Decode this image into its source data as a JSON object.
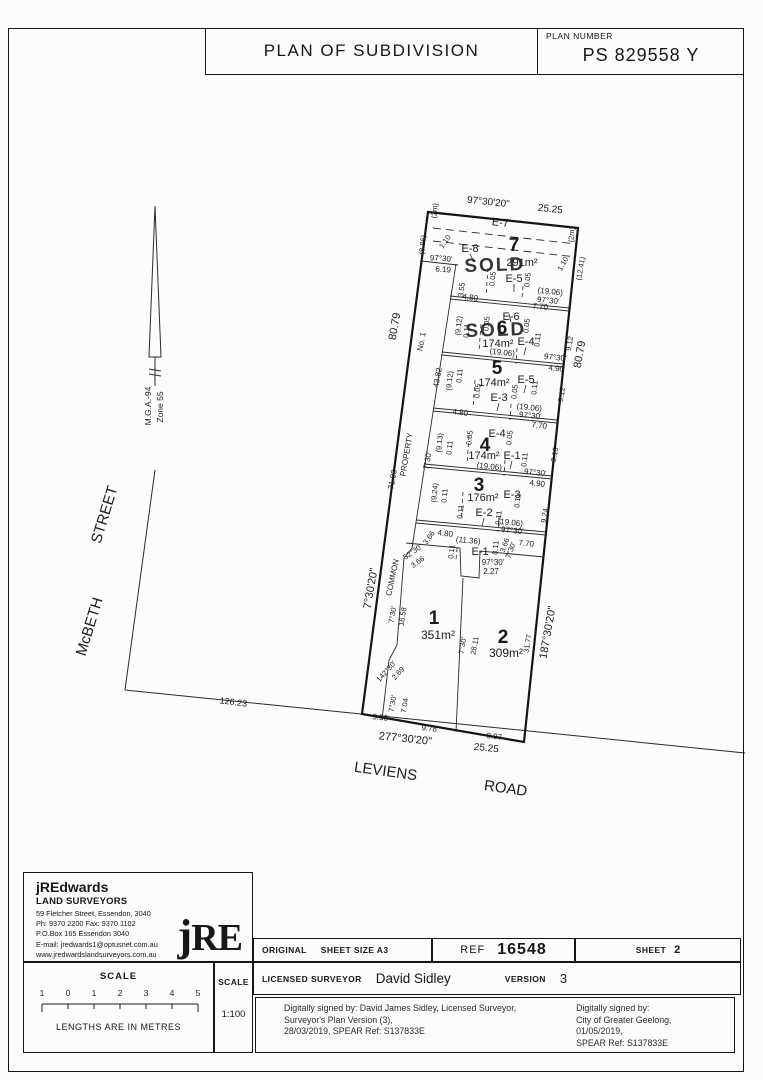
{
  "title_block": {
    "title": "PLAN OF SUBDIVISION",
    "plan_number_label": "PLAN NUMBER",
    "plan_number": "PS 829558 Y"
  },
  "surveyor_box": {
    "name": "jREdwards",
    "subtitle": "LAND SURVEYORS",
    "address1": "59 Fletcher Street, Essendon, 3040",
    "phone": "Ph: 9370 2200      Fax: 9370 1102",
    "address2": "P.O.Box 165 Essendon 3040",
    "email": "E-mail: jredwards1@optusnet.com.au",
    "website": "www.jredwardslandsurveyors.com.au",
    "logo": "RE",
    "logo_j": "j"
  },
  "scale_box": {
    "label": "SCALE",
    "ticks": [
      "1",
      "0",
      "1",
      "2",
      "3",
      "4",
      "5"
    ],
    "caption": "LENGTHS ARE IN METRES",
    "ratio_label": "SCALE",
    "ratio": "1:100"
  },
  "info_row": {
    "original_label": "ORIGINAL",
    "sheet_size": "SHEET SIZE A3",
    "ref_label": "REF",
    "ref_value": "16548",
    "sheet_label": "SHEET",
    "sheet_value": "2"
  },
  "surveyor_row": {
    "licensed_label": "LICENSED SURVEYOR",
    "surveyor_name": "David Sidley",
    "version_label": "VERSION",
    "version_value": "3"
  },
  "signatures": {
    "left": [
      "Digitally signed by: David James Sidley, Licensed Surveyor,",
      "Surveyor's Plan Version (3),",
      "28/03/2019, SPEAR Ref: S137833E"
    ],
    "right": [
      "Digitally signed by:",
      "City of Greater Geelong,",
      "01/05/2019,",
      "SPEAR Ref: S137833E"
    ]
  },
  "plan": {
    "sold_color": "#b63a2e",
    "labels": [
      {
        "t": "97°30'20\"",
        "x": 488,
        "y": 205,
        "r": 6,
        "s": 10
      },
      {
        "t": "25.25",
        "x": 550,
        "y": 212,
        "r": 6,
        "s": 10
      },
      {
        "t": "E-7",
        "x": 500,
        "y": 226,
        "r": 6,
        "s": 11,
        "n": "easement-e7-label"
      },
      {
        "t": "(2m)",
        "x": 437,
        "y": 211,
        "r": -84,
        "s": 7.5
      },
      {
        "t": "(8.86)",
        "x": 425,
        "y": 245,
        "r": -84,
        "s": 7.5
      },
      {
        "t": "1.10",
        "x": 447,
        "y": 243,
        "r": -55,
        "s": 7.5
      },
      {
        "t": "E-8",
        "x": 470,
        "y": 252,
        "s": 11,
        "n": "easement-e8-label"
      },
      {
        "t": "7",
        "x": 514,
        "y": 251,
        "s": 19,
        "w": "b",
        "n": "lot-7-number"
      },
      {
        "t": "291m²",
        "x": 522,
        "y": 266,
        "s": 11,
        "n": "lot-7-area"
      },
      {
        "t": "SOLD",
        "x": 495,
        "y": 271,
        "r": -2,
        "s": 19,
        "w": "b",
        "c": "sold",
        "n": "sold-stamp-lot-7"
      },
      {
        "t": "97°30'",
        "x": 441,
        "y": 261,
        "r": 4,
        "s": 8
      },
      {
        "t": "6.19",
        "x": 443,
        "y": 272,
        "r": 4,
        "s": 8
      },
      {
        "t": "E-5",
        "x": 514,
        "y": 282,
        "s": 11,
        "n": "easement-e5-label"
      },
      {
        "t": "0.05",
        "x": 495,
        "y": 279,
        "r": -84,
        "s": 7.5
      },
      {
        "t": "0.05",
        "x": 530,
        "y": 280,
        "r": -84,
        "s": 7.5
      },
      {
        "t": "3.55",
        "x": 464,
        "y": 290,
        "r": -84,
        "s": 7.5
      },
      {
        "t": "(19.06)",
        "x": 550,
        "y": 294,
        "r": 6,
        "s": 8
      },
      {
        "t": "97°30'",
        "x": 548,
        "y": 303,
        "r": 6,
        "s": 8
      },
      {
        "t": "4.80",
        "x": 470,
        "y": 300,
        "r": 6,
        "s": 8
      },
      {
        "t": "7.70",
        "x": 540,
        "y": 309,
        "r": 6,
        "s": 8
      },
      {
        "t": "(2m)",
        "x": 574,
        "y": 235,
        "r": -84,
        "s": 7.5
      },
      {
        "t": "1.10",
        "x": 565,
        "y": 265,
        "r": -60,
        "s": 7.5
      },
      {
        "t": "(12.41)",
        "x": 583,
        "y": 269,
        "r": -80,
        "s": 7.5
      },
      {
        "t": "(9.12)",
        "x": 461,
        "y": 326,
        "r": -84,
        "s": 7.5
      },
      {
        "t": "0.11",
        "x": 469,
        "y": 331,
        "r": -84,
        "s": 7.5
      },
      {
        "t": "0.05",
        "x": 489,
        "y": 324,
        "r": -84,
        "s": 7.5
      },
      {
        "t": "E-6",
        "x": 511,
        "y": 320,
        "s": 11,
        "n": "easement-e6-label"
      },
      {
        "t": "0.05",
        "x": 529,
        "y": 326,
        "r": -84,
        "s": 7.5
      },
      {
        "t": "6",
        "x": 502,
        "y": 334,
        "s": 19,
        "w": "b",
        "n": "lot-6-number"
      },
      {
        "t": "SOLD",
        "x": 496,
        "y": 336,
        "r": -2,
        "s": 19,
        "w": "b",
        "c": "sold",
        "n": "sold-stamp-lot-6"
      },
      {
        "t": "174m²",
        "x": 498,
        "y": 347,
        "s": 11,
        "n": "lot-6-area"
      },
      {
        "t": "E-4",
        "x": 526,
        "y": 345,
        "s": 11,
        "n": "easement-e4-label"
      },
      {
        "t": "0.11",
        "x": 540,
        "y": 340,
        "r": -84,
        "s": 7.5
      },
      {
        "t": "(19.06)",
        "x": 502,
        "y": 355,
        "r": 6,
        "s": 8
      },
      {
        "t": "9.12",
        "x": 572,
        "y": 344,
        "r": -80,
        "s": 7.5
      },
      {
        "t": "80.79",
        "x": 583,
        "y": 355,
        "r": -80,
        "s": 11
      },
      {
        "t": "97°30'",
        "x": 555,
        "y": 360,
        "r": 6,
        "s": 8
      },
      {
        "t": "4.90",
        "x": 556,
        "y": 371,
        "r": 6,
        "s": 8
      },
      {
        "t": "No. 1",
        "x": 424,
        "y": 342,
        "r": -80,
        "s": 8
      },
      {
        "t": "80.79",
        "x": 398,
        "y": 327,
        "r": -80,
        "s": 11
      },
      {
        "t": "43.82",
        "x": 440,
        "y": 378,
        "r": -80,
        "s": 8
      },
      {
        "t": "(9.12)",
        "x": 452,
        "y": 381,
        "r": -84,
        "s": 7.5
      },
      {
        "t": "0.11",
        "x": 462,
        "y": 376,
        "r": -84,
        "s": 7.5
      },
      {
        "t": "5",
        "x": 497,
        "y": 374,
        "s": 19,
        "w": "b",
        "n": "lot-5-number"
      },
      {
        "t": "174m²",
        "x": 494,
        "y": 386,
        "s": 11,
        "n": "lot-5-area"
      },
      {
        "t": "E-5",
        "x": 526,
        "y": 383,
        "s": 11
      },
      {
        "t": "0.05",
        "x": 480,
        "y": 391,
        "r": -84,
        "s": 7.5
      },
      {
        "t": "0.05",
        "x": 517,
        "y": 392,
        "r": -84,
        "s": 7.5
      },
      {
        "t": "0.11",
        "x": 537,
        "y": 388,
        "r": -84,
        "s": 7.5
      },
      {
        "t": "E-3",
        "x": 499,
        "y": 401,
        "s": 11,
        "n": "easement-e3-label"
      },
      {
        "t": "9.12",
        "x": 564,
        "y": 395,
        "r": -80,
        "s": 7.5
      },
      {
        "t": "(19.06)",
        "x": 529,
        "y": 410,
        "r": 6,
        "s": 8
      },
      {
        "t": "97°30'",
        "x": 530,
        "y": 418,
        "r": 6,
        "s": 8
      },
      {
        "t": "4.80",
        "x": 460,
        "y": 415,
        "r": 6,
        "s": 8
      },
      {
        "t": "7.70",
        "x": 539,
        "y": 428,
        "r": 6,
        "s": 8
      },
      {
        "t": "E-4",
        "x": 497,
        "y": 437,
        "s": 11
      },
      {
        "t": "0.05",
        "x": 472,
        "y": 438,
        "r": -84,
        "s": 7.5
      },
      {
        "t": "0.05",
        "x": 512,
        "y": 438,
        "r": -84,
        "s": 7.5
      },
      {
        "t": "(9.13)",
        "x": 442,
        "y": 443,
        "r": -84,
        "s": 7.5
      },
      {
        "t": "0.11",
        "x": 452,
        "y": 448,
        "r": -84,
        "s": 7.5
      },
      {
        "t": "4",
        "x": 485,
        "y": 451,
        "s": 19,
        "w": "b",
        "n": "lot-4-number"
      },
      {
        "t": "174m²",
        "x": 484,
        "y": 459,
        "s": 11,
        "n": "lot-4-area"
      },
      {
        "t": "E-1",
        "x": 512,
        "y": 459,
        "s": 11,
        "n": "easement-e1-label"
      },
      {
        "t": "0.11",
        "x": 527,
        "y": 460,
        "r": -84,
        "s": 7.5
      },
      {
        "t": "(19.06)",
        "x": 489,
        "y": 469,
        "r": 6,
        "s": 8
      },
      {
        "t": "9.13",
        "x": 557,
        "y": 455,
        "r": -80,
        "s": 7.5
      },
      {
        "t": "97°30'",
        "x": 535,
        "y": 475,
        "r": 6,
        "s": 8
      },
      {
        "t": "4.90",
        "x": 537,
        "y": 486,
        "r": 6,
        "s": 8
      },
      {
        "t": "7°30'",
        "x": 430,
        "y": 461,
        "r": -80,
        "s": 8
      },
      {
        "t": "PROPERTY",
        "x": 409,
        "y": 455,
        "r": -80,
        "s": 8,
        "n": "common-property-label"
      },
      {
        "t": "71.93",
        "x": 395,
        "y": 480,
        "r": -80,
        "s": 8
      },
      {
        "t": "3",
        "x": 479,
        "y": 491,
        "s": 19,
        "w": "b",
        "n": "lot-3-number"
      },
      {
        "t": "(9.24)",
        "x": 437,
        "y": 493,
        "r": -84,
        "s": 7.5
      },
      {
        "t": "0.11",
        "x": 447,
        "y": 496,
        "r": -84,
        "s": 7.5
      },
      {
        "t": "176m²",
        "x": 483,
        "y": 501,
        "s": 11,
        "n": "lot-3-area"
      },
      {
        "t": "E-3",
        "x": 512,
        "y": 498,
        "s": 11
      },
      {
        "t": "0.11",
        "x": 520,
        "y": 501,
        "r": -84,
        "s": 7.5
      },
      {
        "t": "E-2",
        "x": 484,
        "y": 516,
        "s": 11,
        "n": "easement-e2-label"
      },
      {
        "t": "0.11",
        "x": 463,
        "y": 512,
        "r": -84,
        "s": 7.5
      },
      {
        "t": "0.11",
        "x": 501,
        "y": 518,
        "r": -84,
        "s": 7.5
      },
      {
        "t": "9.24",
        "x": 547,
        "y": 516,
        "r": -80,
        "s": 7.5
      },
      {
        "t": "(19.06)",
        "x": 510,
        "y": 525,
        "r": 6,
        "s": 8
      },
      {
        "t": "97°30'",
        "x": 512,
        "y": 533,
        "r": 6,
        "s": 8
      },
      {
        "t": "3.66",
        "x": 431,
        "y": 539,
        "r": -55,
        "s": 7.5
      },
      {
        "t": "4.80",
        "x": 445,
        "y": 536,
        "r": 6,
        "s": 8
      },
      {
        "t": "(11.36)",
        "x": 468,
        "y": 543,
        "r": 6,
        "s": 8
      },
      {
        "t": "0.11",
        "x": 454,
        "y": 552,
        "r": -84,
        "s": 7.5
      },
      {
        "t": "E-1",
        "x": 480,
        "y": 555,
        "s": 11
      },
      {
        "t": "0.11",
        "x": 498,
        "y": 548,
        "r": -84,
        "s": 7.5
      },
      {
        "t": "3.66",
        "x": 507,
        "y": 546,
        "r": -70,
        "s": 7.5
      },
      {
        "t": "7°30'",
        "x": 513,
        "y": 551,
        "r": -70,
        "s": 7.5
      },
      {
        "t": "7.70",
        "x": 526,
        "y": 546,
        "r": 6,
        "s": 8
      },
      {
        "t": "97°30'",
        "x": 493,
        "y": 565,
        "s": 8
      },
      {
        "t": "2.27",
        "x": 491,
        "y": 574,
        "s": 8
      },
      {
        "t": "52°30'",
        "x": 414,
        "y": 554,
        "r": -35,
        "s": 7.5
      },
      {
        "t": "3.66",
        "x": 419,
        "y": 564,
        "r": -35,
        "s": 7.5
      },
      {
        "t": "COMMON",
        "x": 395,
        "y": 578,
        "r": -78,
        "s": 8,
        "n": "common-property-label"
      },
      {
        "t": "7°30'20\"",
        "x": 374,
        "y": 589,
        "r": -80,
        "s": 11
      },
      {
        "t": "7°30'",
        "x": 395,
        "y": 615,
        "r": -80,
        "s": 7.5
      },
      {
        "t": "16.58",
        "x": 405,
        "y": 617,
        "r": -80,
        "s": 7.5
      },
      {
        "t": "1",
        "x": 434,
        "y": 624,
        "s": 19,
        "w": "b",
        "n": "lot-1-number"
      },
      {
        "t": "351m²",
        "x": 438,
        "y": 639,
        "s": 12,
        "n": "lot-1-area"
      },
      {
        "t": "2",
        "x": 503,
        "y": 643,
        "s": 19,
        "w": "b",
        "n": "lot-2-number"
      },
      {
        "t": "309m²",
        "x": 506,
        "y": 657,
        "s": 12,
        "n": "lot-2-area"
      },
      {
        "t": "7°30'",
        "x": 465,
        "y": 646,
        "r": -80,
        "s": 7.5
      },
      {
        "t": "28.11",
        "x": 477,
        "y": 646,
        "r": -80,
        "s": 7.5
      },
      {
        "t": "31.77",
        "x": 530,
        "y": 644,
        "r": -80,
        "s": 7.5
      },
      {
        "t": "187°30'20\"",
        "x": 551,
        "y": 633,
        "r": -80,
        "s": 11
      },
      {
        "t": "142°30'",
        "x": 388,
        "y": 673,
        "r": -48,
        "s": 7.5
      },
      {
        "t": "2.69",
        "x": 400,
        "y": 675,
        "r": -48,
        "s": 7.5
      },
      {
        "t": "7°30'",
        "x": 395,
        "y": 704,
        "r": -80,
        "s": 7.5
      },
      {
        "t": "7.04",
        "x": 407,
        "y": 706,
        "r": -80,
        "s": 7.5
      },
      {
        "t": "5.50",
        "x": 380,
        "y": 720,
        "r": 6,
        "s": 8
      },
      {
        "t": "9.78",
        "x": 429,
        "y": 731,
        "r": 6,
        "s": 8
      },
      {
        "t": "277°30'20\"",
        "x": 405,
        "y": 742,
        "r": 6,
        "s": 11
      },
      {
        "t": "9.97",
        "x": 494,
        "y": 739,
        "r": 6,
        "s": 8
      },
      {
        "t": "25.25",
        "x": 486,
        "y": 751,
        "r": 6,
        "s": 10
      },
      {
        "t": "126.23",
        "x": 233,
        "y": 705,
        "r": 7,
        "s": 9
      },
      {
        "t": "LEVIENS",
        "x": 385,
        "y": 776,
        "r": 8,
        "s": 15,
        "n": "street-label-leviens"
      },
      {
        "t": "ROAD",
        "x": 505,
        "y": 793,
        "r": 8,
        "s": 15,
        "n": "street-label-road"
      },
      {
        "t": "McBETH",
        "x": 94,
        "y": 628,
        "r": -73,
        "s": 15,
        "n": "street-label-mcbeth"
      },
      {
        "t": "STREET",
        "x": 109,
        "y": 516,
        "r": -73,
        "s": 15,
        "n": "street-label-street"
      },
      {
        "t": "M.G.A.-94",
        "x": 151,
        "y": 406,
        "r": -90,
        "s": 8.5,
        "n": "mga-datum-label"
      },
      {
        "t": "Zone 55",
        "x": 163,
        "y": 407,
        "r": -90,
        "s": 8.5,
        "n": "mga-zone-label"
      }
    ]
  }
}
